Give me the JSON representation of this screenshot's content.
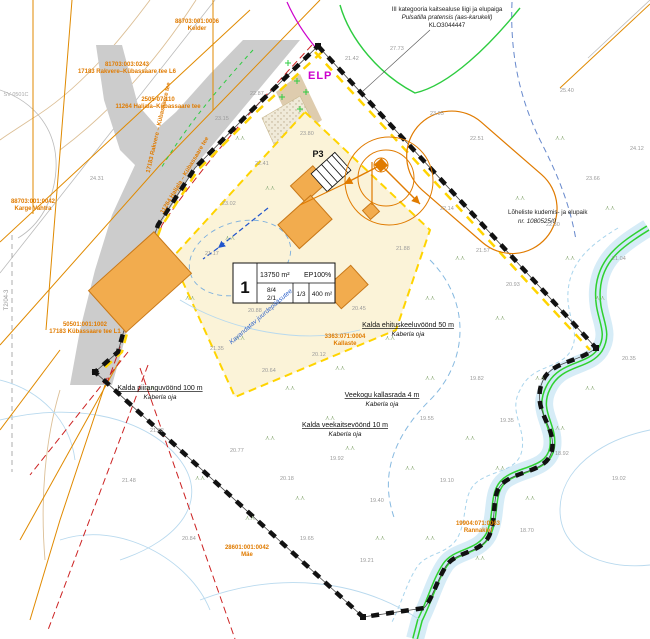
{
  "map": {
    "markers": {
      "elp": "ELP",
      "p3": "P3"
    },
    "species_note": {
      "line1": "III kategooria kaitsealuse liigi ja elupaiga",
      "line2": "Pulsatilla pratensis (aas-karukell)",
      "line3": "KLO3044447"
    },
    "fish_note": {
      "line1": "Lõheliste kudemis- ja elupaik",
      "line2": "nr. 1080525/0"
    },
    "plot_table": {
      "number": "1",
      "area": "13750 m²",
      "ep": "EP100%",
      "heights": "8/4",
      "floors": "2/1",
      "ratio": "1/3",
      "footprint": "400 m²"
    },
    "zone_labels": [
      {
        "x": 160,
        "y": 390,
        "title": "Kalda piiranguvöönd 100 m",
        "sub": "Kaberla oja"
      },
      {
        "x": 408,
        "y": 327,
        "title": "Kalda ehituskeeluvöönd 50 m",
        "sub": "Kaberla oja"
      },
      {
        "x": 382,
        "y": 397,
        "title": "Veekogu kallasrada 4 m",
        "sub": "Kaberla oja"
      },
      {
        "x": 345,
        "y": 427,
        "title": "Kalda veekaitsevöönd 10 m",
        "sub": "Kaberla oja"
      }
    ],
    "road_labels": [
      {
        "x": 160,
        "y": 128,
        "rot": -77,
        "text": "17183 Rakvere – Kübassaare tee"
      },
      {
        "x": 186,
        "y": 176,
        "rot": -59,
        "text": "11264 Haljala – Kübassaare tee"
      }
    ],
    "cadastral_labels": [
      {
        "x": 127,
        "y": 66,
        "line1": "81703:003:0243",
        "line2": "17183 Rakvere–Kübassaare tee L6"
      },
      {
        "x": 197,
        "y": 23,
        "line1": "88703:001:0006",
        "line2": "Kelder"
      },
      {
        "x": 158,
        "y": 101,
        "line1": "2505-07.110",
        "line2": "11264 Haljala–Kübassaare tee"
      },
      {
        "x": 33,
        "y": 203,
        "line1": "88703:001:0042",
        "line2": "Karge Vahtra"
      },
      {
        "x": 85,
        "y": 326,
        "line1": "50501:001:1002",
        "line2": "17183 Kübassaare tee L1"
      },
      {
        "x": 247,
        "y": 549,
        "line1": "28601:001:0042",
        "line2": "Mäe"
      },
      {
        "x": 478,
        "y": 525,
        "line1": "19904:071:0063",
        "line2": "Rannakivi"
      },
      {
        "x": 345,
        "y": 338,
        "line1": "3363:071:0004",
        "line2": "Kallaste"
      }
    ],
    "misc_labels": [
      {
        "x": 16,
        "y": 96,
        "text": "SV-0501C",
        "color": "#aaaaaa",
        "size": 5.5,
        "rot": 0,
        "italic": false
      },
      {
        "x": 8,
        "y": 300,
        "text": "T2/04-3",
        "color": "#999999",
        "size": 6,
        "rot": -90,
        "italic": false
      },
      {
        "x": 262,
        "y": 318,
        "text": "Kavandatav juurdepääsutee",
        "color": "#3366cc",
        "size": 6.5,
        "rot": -41,
        "italic": true
      }
    ],
    "elevations": [
      {
        "x": 215,
        "y": 120,
        "v": "23.15"
      },
      {
        "x": 250,
        "y": 95,
        "v": "22.87"
      },
      {
        "x": 345,
        "y": 60,
        "v": "21.42"
      },
      {
        "x": 390,
        "y": 50,
        "v": "27.73"
      },
      {
        "x": 430,
        "y": 115,
        "v": "23.05"
      },
      {
        "x": 470,
        "y": 140,
        "v": "22.51"
      },
      {
        "x": 300,
        "y": 135,
        "v": "23.80"
      },
      {
        "x": 255,
        "y": 165,
        "v": "22.41"
      },
      {
        "x": 222,
        "y": 205,
        "v": "23.02"
      },
      {
        "x": 205,
        "y": 255,
        "v": "21.17"
      },
      {
        "x": 248,
        "y": 312,
        "v": "20.88"
      },
      {
        "x": 210,
        "y": 350,
        "v": "21.35"
      },
      {
        "x": 262,
        "y": 372,
        "v": "20.64"
      },
      {
        "x": 312,
        "y": 356,
        "v": "20.12"
      },
      {
        "x": 352,
        "y": 310,
        "v": "20.45"
      },
      {
        "x": 396,
        "y": 250,
        "v": "21.88"
      },
      {
        "x": 440,
        "y": 210,
        "v": "22.14"
      },
      {
        "x": 476,
        "y": 252,
        "v": "21.57"
      },
      {
        "x": 506,
        "y": 286,
        "v": "20.93"
      },
      {
        "x": 546,
        "y": 226,
        "v": "22.30"
      },
      {
        "x": 586,
        "y": 180,
        "v": "23.66"
      },
      {
        "x": 612,
        "y": 260,
        "v": "21.04"
      },
      {
        "x": 470,
        "y": 380,
        "v": "19.82"
      },
      {
        "x": 420,
        "y": 420,
        "v": "19.55"
      },
      {
        "x": 330,
        "y": 460,
        "v": "19.92"
      },
      {
        "x": 280,
        "y": 480,
        "v": "20.18"
      },
      {
        "x": 230,
        "y": 452,
        "v": "20.77"
      },
      {
        "x": 370,
        "y": 502,
        "v": "19.40"
      },
      {
        "x": 440,
        "y": 482,
        "v": "19.10"
      },
      {
        "x": 500,
        "y": 422,
        "v": "19.35"
      },
      {
        "x": 555,
        "y": 455,
        "v": "18.92"
      },
      {
        "x": 300,
        "y": 540,
        "v": "19.65"
      },
      {
        "x": 360,
        "y": 562,
        "v": "19.21"
      },
      {
        "x": 150,
        "y": 432,
        "v": "21.02"
      },
      {
        "x": 122,
        "y": 482,
        "v": "21.48"
      },
      {
        "x": 182,
        "y": 540,
        "v": "20.84"
      },
      {
        "x": 90,
        "y": 180,
        "v": "24.31"
      },
      {
        "x": 520,
        "y": 532,
        "v": "18.70"
      },
      {
        "x": 612,
        "y": 480,
        "v": "19.02"
      },
      {
        "x": 622,
        "y": 360,
        "v": "20.35"
      },
      {
        "x": 630,
        "y": 150,
        "v": "24.12"
      },
      {
        "x": 560,
        "y": 92,
        "v": "25.40"
      }
    ],
    "grass": [
      {
        "x": 240,
        "y": 140
      },
      {
        "x": 270,
        "y": 190
      },
      {
        "x": 230,
        "y": 240
      },
      {
        "x": 190,
        "y": 300
      },
      {
        "x": 240,
        "y": 340
      },
      {
        "x": 290,
        "y": 390
      },
      {
        "x": 340,
        "y": 370
      },
      {
        "x": 390,
        "y": 340
      },
      {
        "x": 430,
        "y": 300
      },
      {
        "x": 460,
        "y": 260
      },
      {
        "x": 500,
        "y": 320
      },
      {
        "x": 540,
        "y": 380
      },
      {
        "x": 470,
        "y": 440
      },
      {
        "x": 410,
        "y": 470
      },
      {
        "x": 350,
        "y": 450
      },
      {
        "x": 300,
        "y": 500
      },
      {
        "x": 250,
        "y": 520
      },
      {
        "x": 200,
        "y": 480
      },
      {
        "x": 380,
        "y": 540
      },
      {
        "x": 430,
        "y": 540
      },
      {
        "x": 480,
        "y": 560
      },
      {
        "x": 530,
        "y": 500
      },
      {
        "x": 560,
        "y": 430
      },
      {
        "x": 590,
        "y": 390
      },
      {
        "x": 600,
        "y": 300
      },
      {
        "x": 570,
        "y": 260
      },
      {
        "x": 520,
        "y": 200
      },
      {
        "x": 560,
        "y": 140
      },
      {
        "x": 610,
        "y": 210
      },
      {
        "x": 330,
        "y": 420
      },
      {
        "x": 270,
        "y": 440
      },
      {
        "x": 150,
        "y": 390
      },
      {
        "x": 500,
        "y": 470
      },
      {
        "x": 430,
        "y": 380
      }
    ],
    "colors": {
      "boundary": "#111111",
      "road_fill": "#cccccc",
      "orange": "#e07b00",
      "building_fill": "#f2ac4e",
      "building_stroke": "#c87818",
      "cream": "#fbf3d8",
      "yellow": "#ffd400",
      "magenta": "#cc00cc",
      "red": "#cc2222",
      "stream_green": "#2fd12f",
      "water_band": "#d6ecf7",
      "contour_blue": "#b8d9ee",
      "grass_green": "#98b486",
      "elevation_gray": "#9a9a9a"
    }
  }
}
